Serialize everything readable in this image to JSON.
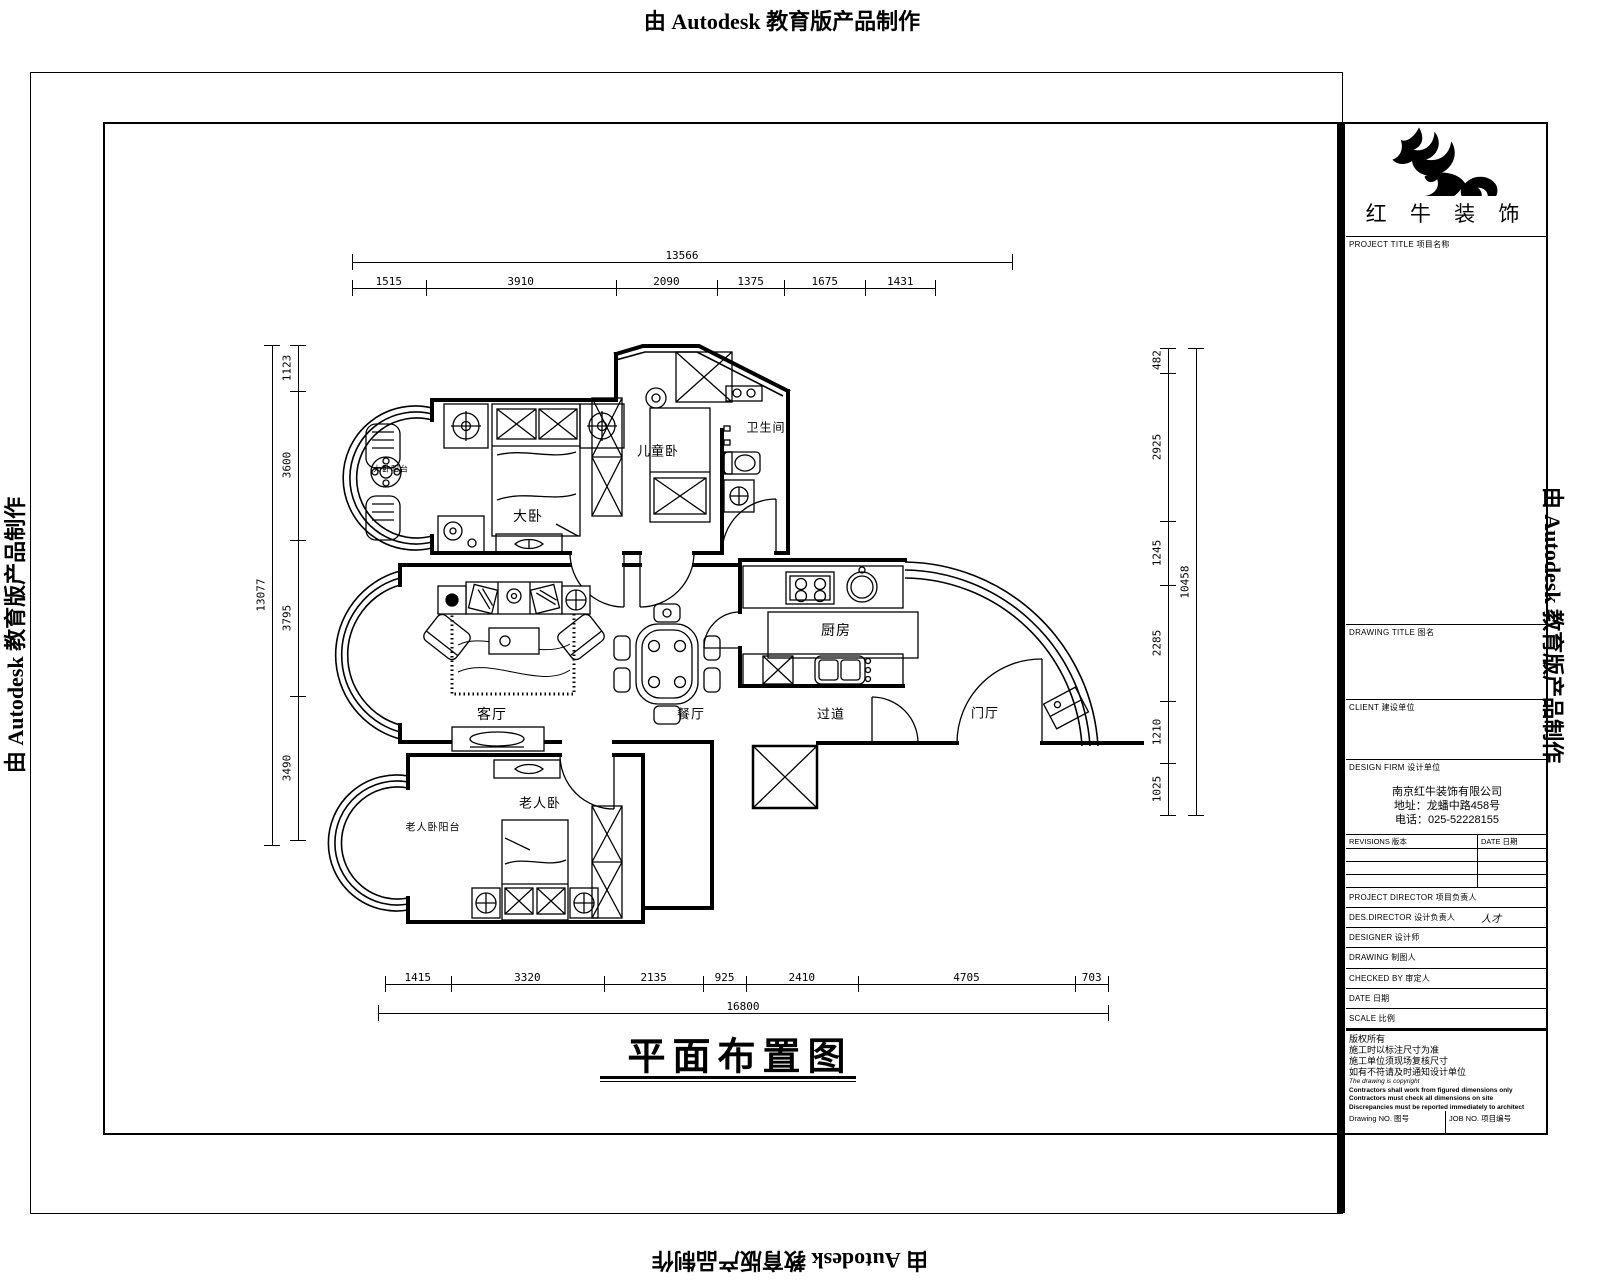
{
  "banner": {
    "text": "由 Autodesk 教育版产品制作"
  },
  "drawing": {
    "title": "平面布置图",
    "rooms": [
      {
        "label": "大卧阳台",
        "x": 391,
        "y": 469,
        "size": 8,
        "w": 36
      },
      {
        "label": "大卧",
        "x": 528,
        "y": 516,
        "size": 14
      },
      {
        "label": "儿童卧",
        "x": 658,
        "y": 450,
        "size": 13
      },
      {
        "label": "卫生间",
        "x": 766,
        "y": 427,
        "size": 12
      },
      {
        "label": "厨房",
        "x": 836,
        "y": 630,
        "size": 14
      },
      {
        "label": "客厅",
        "x": 492,
        "y": 714,
        "size": 14
      },
      {
        "label": "餐厅",
        "x": 691,
        "y": 713,
        "size": 13
      },
      {
        "label": "过道",
        "x": 831,
        "y": 713,
        "size": 13
      },
      {
        "label": "门厅",
        "x": 985,
        "y": 712,
        "size": 13
      },
      {
        "label": "老人卧",
        "x": 540,
        "y": 802,
        "size": 13
      },
      {
        "label": "老人卧阳台",
        "x": 433,
        "y": 826,
        "size": 10
      }
    ],
    "dims": {
      "top": {
        "total": [
          "13566"
        ],
        "segments": [
          "1515",
          "3910",
          "2090",
          "1375",
          "1675",
          "1431"
        ]
      },
      "left": {
        "total": [
          "13077"
        ],
        "segments": [
          "1123",
          "3600",
          "3795",
          "3490"
        ]
      },
      "right": {
        "total": [
          "10458"
        ],
        "segments": [
          "482",
          "2925",
          "1245",
          "2285",
          "1210",
          "1025"
        ]
      },
      "bottom": {
        "total": [
          "16800"
        ],
        "segments": [
          "1415",
          "3320",
          "2135",
          "925",
          "2410",
          "4705",
          "703"
        ]
      }
    }
  },
  "title_block": {
    "company": "红 牛 装 饰",
    "project_label": "PROJECT TITLE 项目名称",
    "drawing_title_label": "DRAWING TITLE 图名",
    "client_label": "CLIENT 建设单位",
    "firm_label": "DESIGN FIRM 设计单位",
    "firm_name": "南京红牛装饰有限公司",
    "firm_address": "地址：龙蟠中路458号",
    "firm_phone": "电话：025-52228155",
    "revisions_label": "REVISIONS 版本",
    "rev_date_label": "DATE 日期",
    "rows": [
      {
        "label": "PROJECT DIRECTOR 项目负责人",
        "value": ""
      },
      {
        "label": "DES.DIRECTOR 设计负责人",
        "value": "人才"
      },
      {
        "label": "DESIGNER 设计师",
        "value": ""
      },
      {
        "label": "DRAWING 制图人",
        "value": ""
      },
      {
        "label": "CHECKED BY 审定人",
        "value": ""
      },
      {
        "label": "DATE 日期",
        "value": ""
      },
      {
        "label": "SCALE 比例",
        "value": ""
      }
    ],
    "notes": [
      "版权所有",
      "施工时以标注尺寸为准",
      "施工单位须现场复核尺寸",
      "如有不符请及时通知设计单位",
      "The drawing is copyright",
      "Contractors shall work from figured dimensions only",
      "Contractors must check all dimensions on site",
      "Discrepancies must be reported immediately to architect"
    ],
    "drawing_no_label": "Drawing NO. 图号",
    "job_no_label": "JOB NO. 项目编号"
  }
}
